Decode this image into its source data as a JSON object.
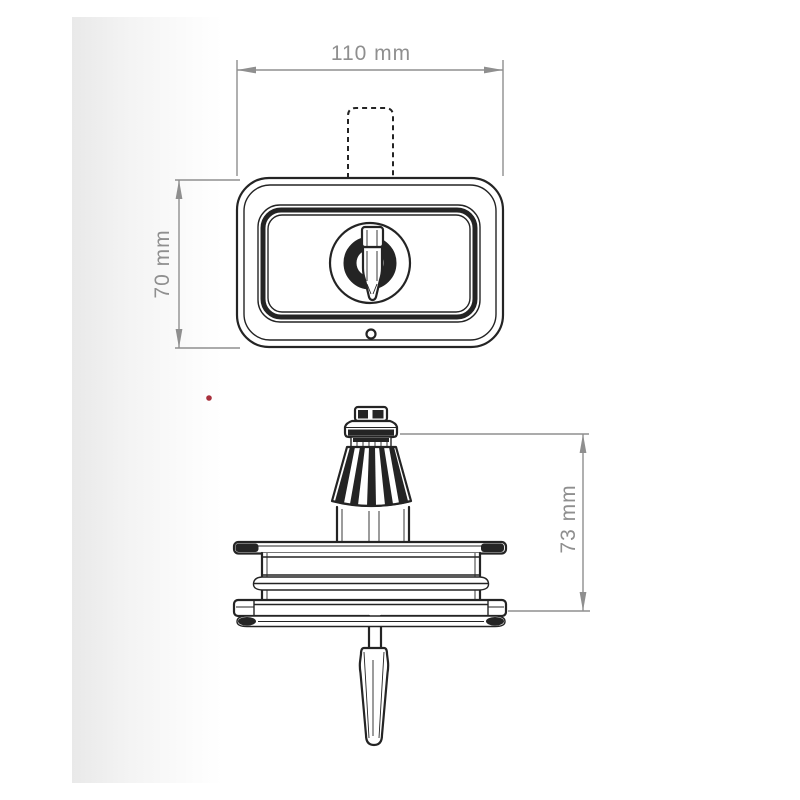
{
  "meta": {
    "description": "Technical dimension drawing of a key-operated cam lock, front view and side profile view"
  },
  "colors": {
    "line": "#242424",
    "dimension": "#8f8f8f",
    "marker": "#a8303c",
    "page_bg": "#ffffff",
    "shade_left": "#e9e9e9"
  },
  "views": {
    "front": {
      "width_mm": 110,
      "height_mm": 70
    },
    "side": {
      "height_mm": 73
    }
  },
  "dimensions": {
    "width_label": "110 mm",
    "height_label": "70 mm",
    "depth_label": "73 mm"
  }
}
